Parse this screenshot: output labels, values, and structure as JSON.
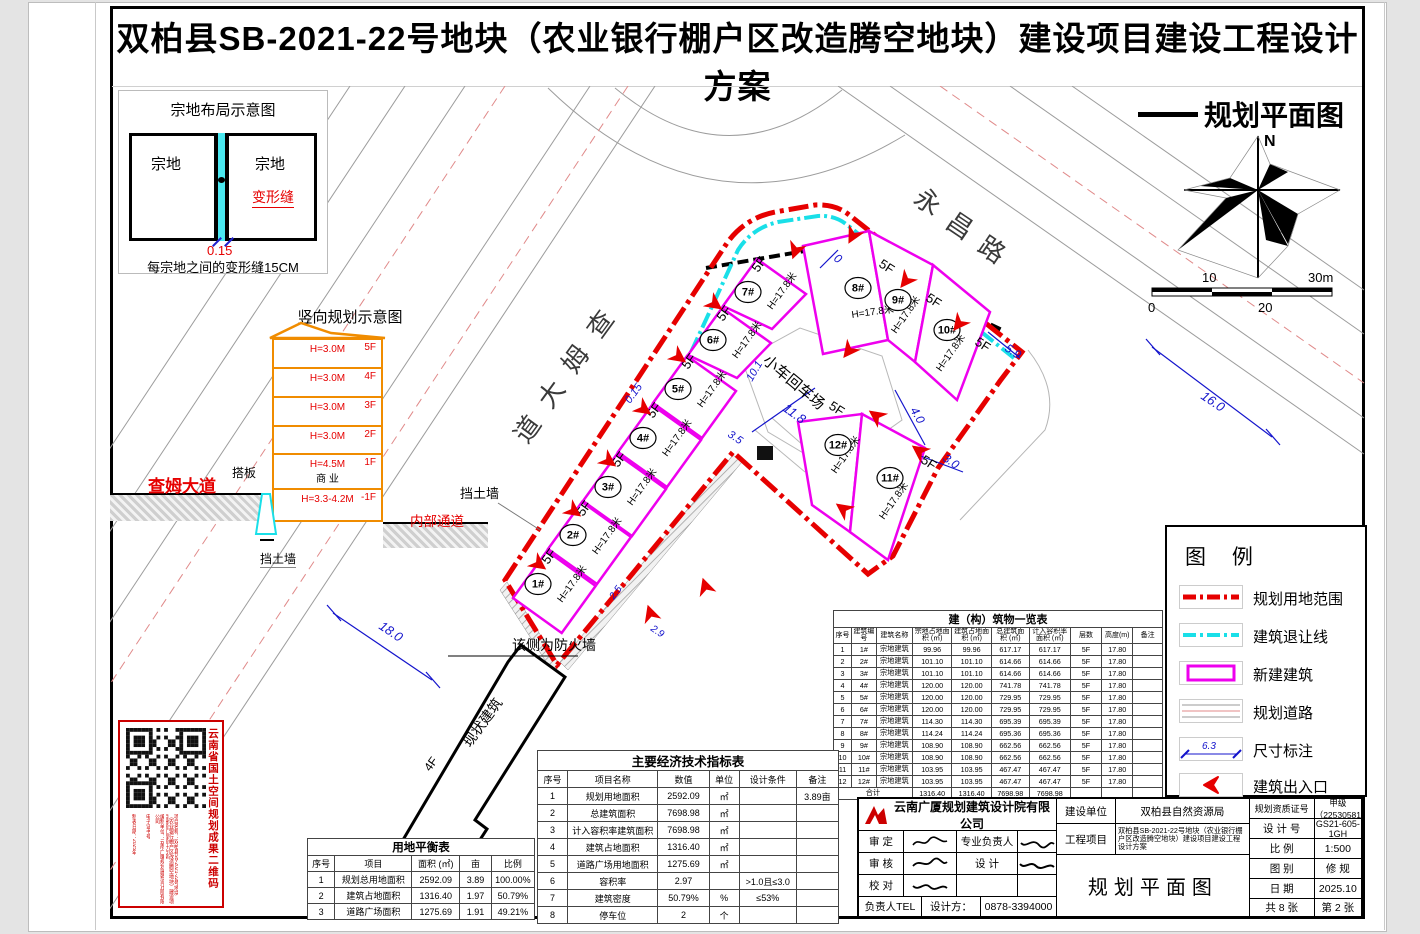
{
  "page": {
    "title": "双柏县SB-2021-22号地块（农业银行棚户区改造腾空地块）建设项目建设工程设计方案",
    "drawing_title": "规划平面图"
  },
  "parcel": {
    "title": "宗地布局示意图",
    "left": "宗地",
    "right": "宗地",
    "joint": "变形缝",
    "dim": "0.15",
    "caption": "每宗地之间的变形缝15CM"
  },
  "sec": {
    "title": "竖向规划示意图",
    "floors": [
      {
        "tag": "5F",
        "h": "H=3.0M"
      },
      {
        "tag": "4F",
        "h": "H=3.0M"
      },
      {
        "tag": "3F",
        "h": "H=3.0M"
      },
      {
        "tag": "2F",
        "h": "H=3.0M"
      },
      {
        "tag": "1F",
        "h": "H=4.5M",
        "use": "商 业"
      },
      {
        "tag": "-1F",
        "h": "H=3.3-4.2M"
      }
    ],
    "slab": "搭板",
    "road": "查姆大道",
    "wall": "挡土墙",
    "passage": "内部通道"
  },
  "plan": {
    "north": "N",
    "scale_ticks": [
      "0",
      "10",
      "20",
      "30m"
    ],
    "labels": [
      [
        "查",
        600,
        340,
        -54,
        "road",
        26
      ],
      [
        "姆",
        575,
        375,
        -54,
        "road",
        26
      ],
      [
        "大",
        551,
        410,
        -54,
        "road",
        26
      ],
      [
        "道",
        527,
        445,
        -54,
        "road",
        26
      ],
      [
        "永",
        912,
        202,
        34,
        "road",
        26
      ],
      [
        "昌",
        944,
        226,
        34,
        "road",
        26
      ],
      [
        "路",
        976,
        250,
        34,
        "road",
        26
      ],
      [
        "18.0",
        378,
        628,
        34,
        "dim",
        13
      ],
      [
        "16.0",
        1200,
        398,
        34,
        "dim",
        13
      ],
      [
        "0.15",
        630,
        404,
        -54,
        "dim",
        11
      ],
      [
        "10.1",
        752,
        382,
        -60,
        "dim",
        11
      ],
      [
        "11.8",
        782,
        410,
        36,
        "dim",
        13
      ],
      [
        "4.0",
        910,
        410,
        60,
        "dim",
        12
      ],
      [
        "3.0",
        942,
        460,
        34,
        "dim",
        12
      ],
      [
        "5.9",
        1004,
        350,
        34,
        "dim",
        12
      ],
      [
        "0",
        833,
        260,
        34,
        "dim",
        12
      ],
      [
        "3.5",
        727,
        436,
        34,
        "dim",
        11
      ],
      [
        "2.5",
        614,
        600,
        -54,
        "dim",
        10
      ],
      [
        "2.9",
        650,
        630,
        34,
        "dim",
        10
      ],
      [
        "挡土墙",
        460,
        498,
        0,
        "pl",
        13
      ],
      [
        "该侧为防火墙",
        512,
        650,
        0,
        "pl",
        14
      ],
      [
        "现状建筑",
        470,
        748,
        -54,
        "pl",
        14
      ],
      [
        "4F",
        430,
        772,
        -54,
        "pl",
        12
      ],
      [
        "小车回车场",
        762,
        362,
        40,
        "pl",
        15
      ],
      [
        "5F",
        548,
        565,
        -54,
        "pl",
        13
      ],
      [
        "5F",
        583,
        517,
        -54,
        "pl",
        13
      ],
      [
        "5F",
        618,
        468,
        -54,
        "pl",
        13
      ],
      [
        "5F",
        653,
        419,
        -54,
        "pl",
        13
      ],
      [
        "5F",
        688,
        370,
        -54,
        "pl",
        13
      ],
      [
        "5F",
        723,
        322,
        -54,
        "pl",
        13
      ],
      [
        "5F",
        758,
        273,
        -54,
        "pl",
        13
      ],
      [
        "5F",
        878,
        266,
        33,
        "pl",
        13
      ],
      [
        "5F",
        925,
        300,
        33,
        "pl",
        13
      ],
      [
        "5F",
        974,
        344,
        33,
        "pl",
        13
      ],
      [
        "5F",
        828,
        408,
        33,
        "pl",
        13
      ],
      [
        "5F",
        920,
        462,
        33,
        "pl",
        13
      ],
      [
        "H=17.8米",
        562,
        603,
        -54,
        "pl",
        10
      ],
      [
        "H=17.8米",
        597,
        555,
        -54,
        "pl",
        10
      ],
      [
        "H=17.8米",
        632,
        506,
        -54,
        "pl",
        10
      ],
      [
        "H=17.8米",
        667,
        457,
        -54,
        "pl",
        10
      ],
      [
        "H=17.8米",
        702,
        408,
        -54,
        "pl",
        10
      ],
      [
        "H=17.8米",
        737,
        359,
        -54,
        "pl",
        10
      ],
      [
        "H=17.8米",
        772,
        310,
        -54,
        "pl",
        10
      ],
      [
        "H=17.8米",
        852,
        318,
        -8,
        "pl",
        10
      ],
      [
        "H=17.8米",
        896,
        334,
        -55,
        "pl",
        10
      ],
      [
        "H=17.8米",
        941,
        372,
        -55,
        "pl",
        10
      ],
      [
        "H=17.8米",
        836,
        474,
        -55,
        "pl",
        10
      ],
      [
        "H=17.8米",
        884,
        520,
        -55,
        "pl",
        10
      ]
    ],
    "circles": [
      [
        "1#",
        538,
        584
      ],
      [
        "2#",
        573,
        535
      ],
      [
        "3#",
        608,
        487
      ],
      [
        "4#",
        643,
        438
      ],
      [
        "5#",
        678,
        389
      ],
      [
        "6#",
        713,
        340
      ],
      [
        "7#",
        748,
        292
      ],
      [
        "8#",
        858,
        288
      ],
      [
        "9#",
        898,
        300
      ],
      [
        "10#",
        947,
        330
      ],
      [
        "11#",
        890,
        478
      ],
      [
        "12#",
        838,
        445
      ]
    ],
    "entrances": [
      [
        540,
        565,
        36
      ],
      [
        575,
        512,
        36
      ],
      [
        610,
        462,
        36
      ],
      [
        645,
        410,
        36
      ],
      [
        680,
        358,
        36
      ],
      [
        716,
        305,
        36
      ],
      [
        795,
        252,
        110
      ],
      [
        852,
        237,
        118
      ],
      [
        905,
        282,
        128
      ],
      [
        958,
        325,
        128
      ],
      [
        848,
        352,
        128
      ],
      [
        875,
        415,
        216
      ],
      [
        918,
        450,
        216
      ],
      [
        842,
        508,
        216
      ],
      [
        650,
        612,
        252
      ],
      [
        705,
        585,
        252
      ]
    ]
  },
  "legend": {
    "title": "图 例",
    "dim_sample": "6.3",
    "items": [
      {
        "label": "规划用地范围"
      },
      {
        "label": "建筑退让线"
      },
      {
        "label": "新建建筑"
      },
      {
        "label": "规划道路"
      },
      {
        "label": "尺寸标注"
      },
      {
        "label": "建筑出入口"
      }
    ]
  },
  "bt": {
    "title": "建（构）筑物一览表",
    "headers": [
      "序号",
      "建筑编号",
      "建筑名称",
      "宗地占地面积 (㎡)",
      "建筑占地面积 (㎡)",
      "总建筑面积 (㎡)",
      "计入容积率面积 (㎡)",
      "层数",
      "高度(m)",
      "备注"
    ],
    "rows": [
      [
        "1",
        "1#",
        "宗地建筑",
        "99.96",
        "99.96",
        "617.17",
        "617.17",
        "5F",
        "17.80",
        ""
      ],
      [
        "2",
        "2#",
        "宗地建筑",
        "101.10",
        "101.10",
        "614.66",
        "614.66",
        "5F",
        "17.80",
        ""
      ],
      [
        "3",
        "3#",
        "宗地建筑",
        "101.10",
        "101.10",
        "614.66",
        "614.66",
        "5F",
        "17.80",
        ""
      ],
      [
        "4",
        "4#",
        "宗地建筑",
        "120.00",
        "120.00",
        "741.78",
        "741.78",
        "5F",
        "17.80",
        ""
      ],
      [
        "5",
        "5#",
        "宗地建筑",
        "120.00",
        "120.00",
        "729.95",
        "729.95",
        "5F",
        "17.80",
        ""
      ],
      [
        "6",
        "6#",
        "宗地建筑",
        "120.00",
        "120.00",
        "729.95",
        "729.95",
        "5F",
        "17.80",
        ""
      ],
      [
        "7",
        "7#",
        "宗地建筑",
        "114.30",
        "114.30",
        "695.39",
        "695.39",
        "5F",
        "17.80",
        ""
      ],
      [
        "8",
        "8#",
        "宗地建筑",
        "114.24",
        "114.24",
        "695.36",
        "695.36",
        "5F",
        "17.80",
        ""
      ],
      [
        "9",
        "9#",
        "宗地建筑",
        "108.90",
        "108.90",
        "662.56",
        "662.56",
        "5F",
        "17.80",
        ""
      ],
      [
        "10",
        "10#",
        "宗地建筑",
        "108.90",
        "108.90",
        "662.56",
        "662.56",
        "5F",
        "17.80",
        ""
      ],
      [
        "11",
        "11#",
        "宗地建筑",
        "103.95",
        "103.95",
        "467.47",
        "467.47",
        "5F",
        "17.80",
        ""
      ],
      [
        "12",
        "12#",
        "宗地建筑",
        "103.95",
        "103.95",
        "467.47",
        "467.47",
        "5F",
        "17.80",
        ""
      ]
    ],
    "total": [
      "合计",
      "1316.40",
      "1316.40",
      "7698.98",
      "7698.98",
      "",
      "",
      ""
    ]
  },
  "it": {
    "title": "主要经济技术指标表",
    "headers": [
      "序号",
      "项目名称",
      "数值",
      "单位",
      "设计条件",
      "备注"
    ],
    "rows": [
      [
        "1",
        "规划用地面积",
        "2592.09",
        "㎡",
        "",
        "3.89亩"
      ],
      [
        "2",
        "总建筑面积",
        "7698.98",
        "㎡",
        "",
        ""
      ],
      [
        "3",
        "计入容积率建筑面积",
        "7698.98",
        "㎡",
        "",
        ""
      ],
      [
        "4",
        "建筑占地面积",
        "1316.40",
        "㎡",
        "",
        ""
      ],
      [
        "5",
        "道路广场用地面积",
        "1275.69",
        "㎡",
        "",
        ""
      ],
      [
        "6",
        "容积率",
        "2.97",
        "",
        ">1.0且≤3.0",
        ""
      ],
      [
        "7",
        "建筑密度",
        "50.79%",
        "%",
        "≤53%",
        ""
      ],
      [
        "8",
        "停车位",
        "2",
        "个",
        "",
        ""
      ]
    ]
  },
  "lt": {
    "title": "用地平衡表",
    "headers": [
      "序号",
      "项目",
      "面积 (㎡)",
      "亩",
      "比例"
    ],
    "rows": [
      [
        "1",
        "规划总用地面积",
        "2592.09",
        "3.89",
        "100.00%"
      ],
      [
        "2",
        "建筑占地面积",
        "1316.40",
        "1.97",
        "50.79%"
      ],
      [
        "3",
        "道路广场面积",
        "1275.69",
        "1.91",
        "49.21%"
      ]
    ]
  },
  "tb": {
    "company": "云南广厦规划建筑设计院有限公司",
    "approve_label": "审  定",
    "check_label": "审  核",
    "proof_label": "校  对",
    "lead_label": "专业负责人",
    "design_label": "设  计",
    "tel_label": "负责人TEL",
    "designer_label": "设计方：",
    "tel": "0878-3394000",
    "owner_label": "建设单位",
    "owner": "双柏县自然资源局",
    "project_label": "工程项目",
    "project": "双柏县SB-2021-22号地块（农业银行棚户区改造腾空地块）建设项目建设工程设计方案",
    "drawing_name": "规划平面图",
    "cert_label": "规划资质证号",
    "cert": "甲级（22530581",
    "no_label": "设 计 号",
    "no": "GS21-605-1GH",
    "scale_label": "比  例",
    "scale": "1:500",
    "cat_label": "图  别",
    "cat": "修  规",
    "date_label": "日  期",
    "date": "2025.10",
    "sheets": "共 8 张",
    "sheet_no": "第 2 张"
  },
  "qr": {
    "side": "云南省国土空间规划成果二维码",
    "cols": [
      "项目名称：双柏县SB-2021-22号地块（农业银行棚户区改造腾空地块）建设项目建设工程设计方案",
      "编制单位：云南广厦规划建筑设计院有限公司",
      "电子证书号",
      "制表日期：2025年"
    ]
  }
}
